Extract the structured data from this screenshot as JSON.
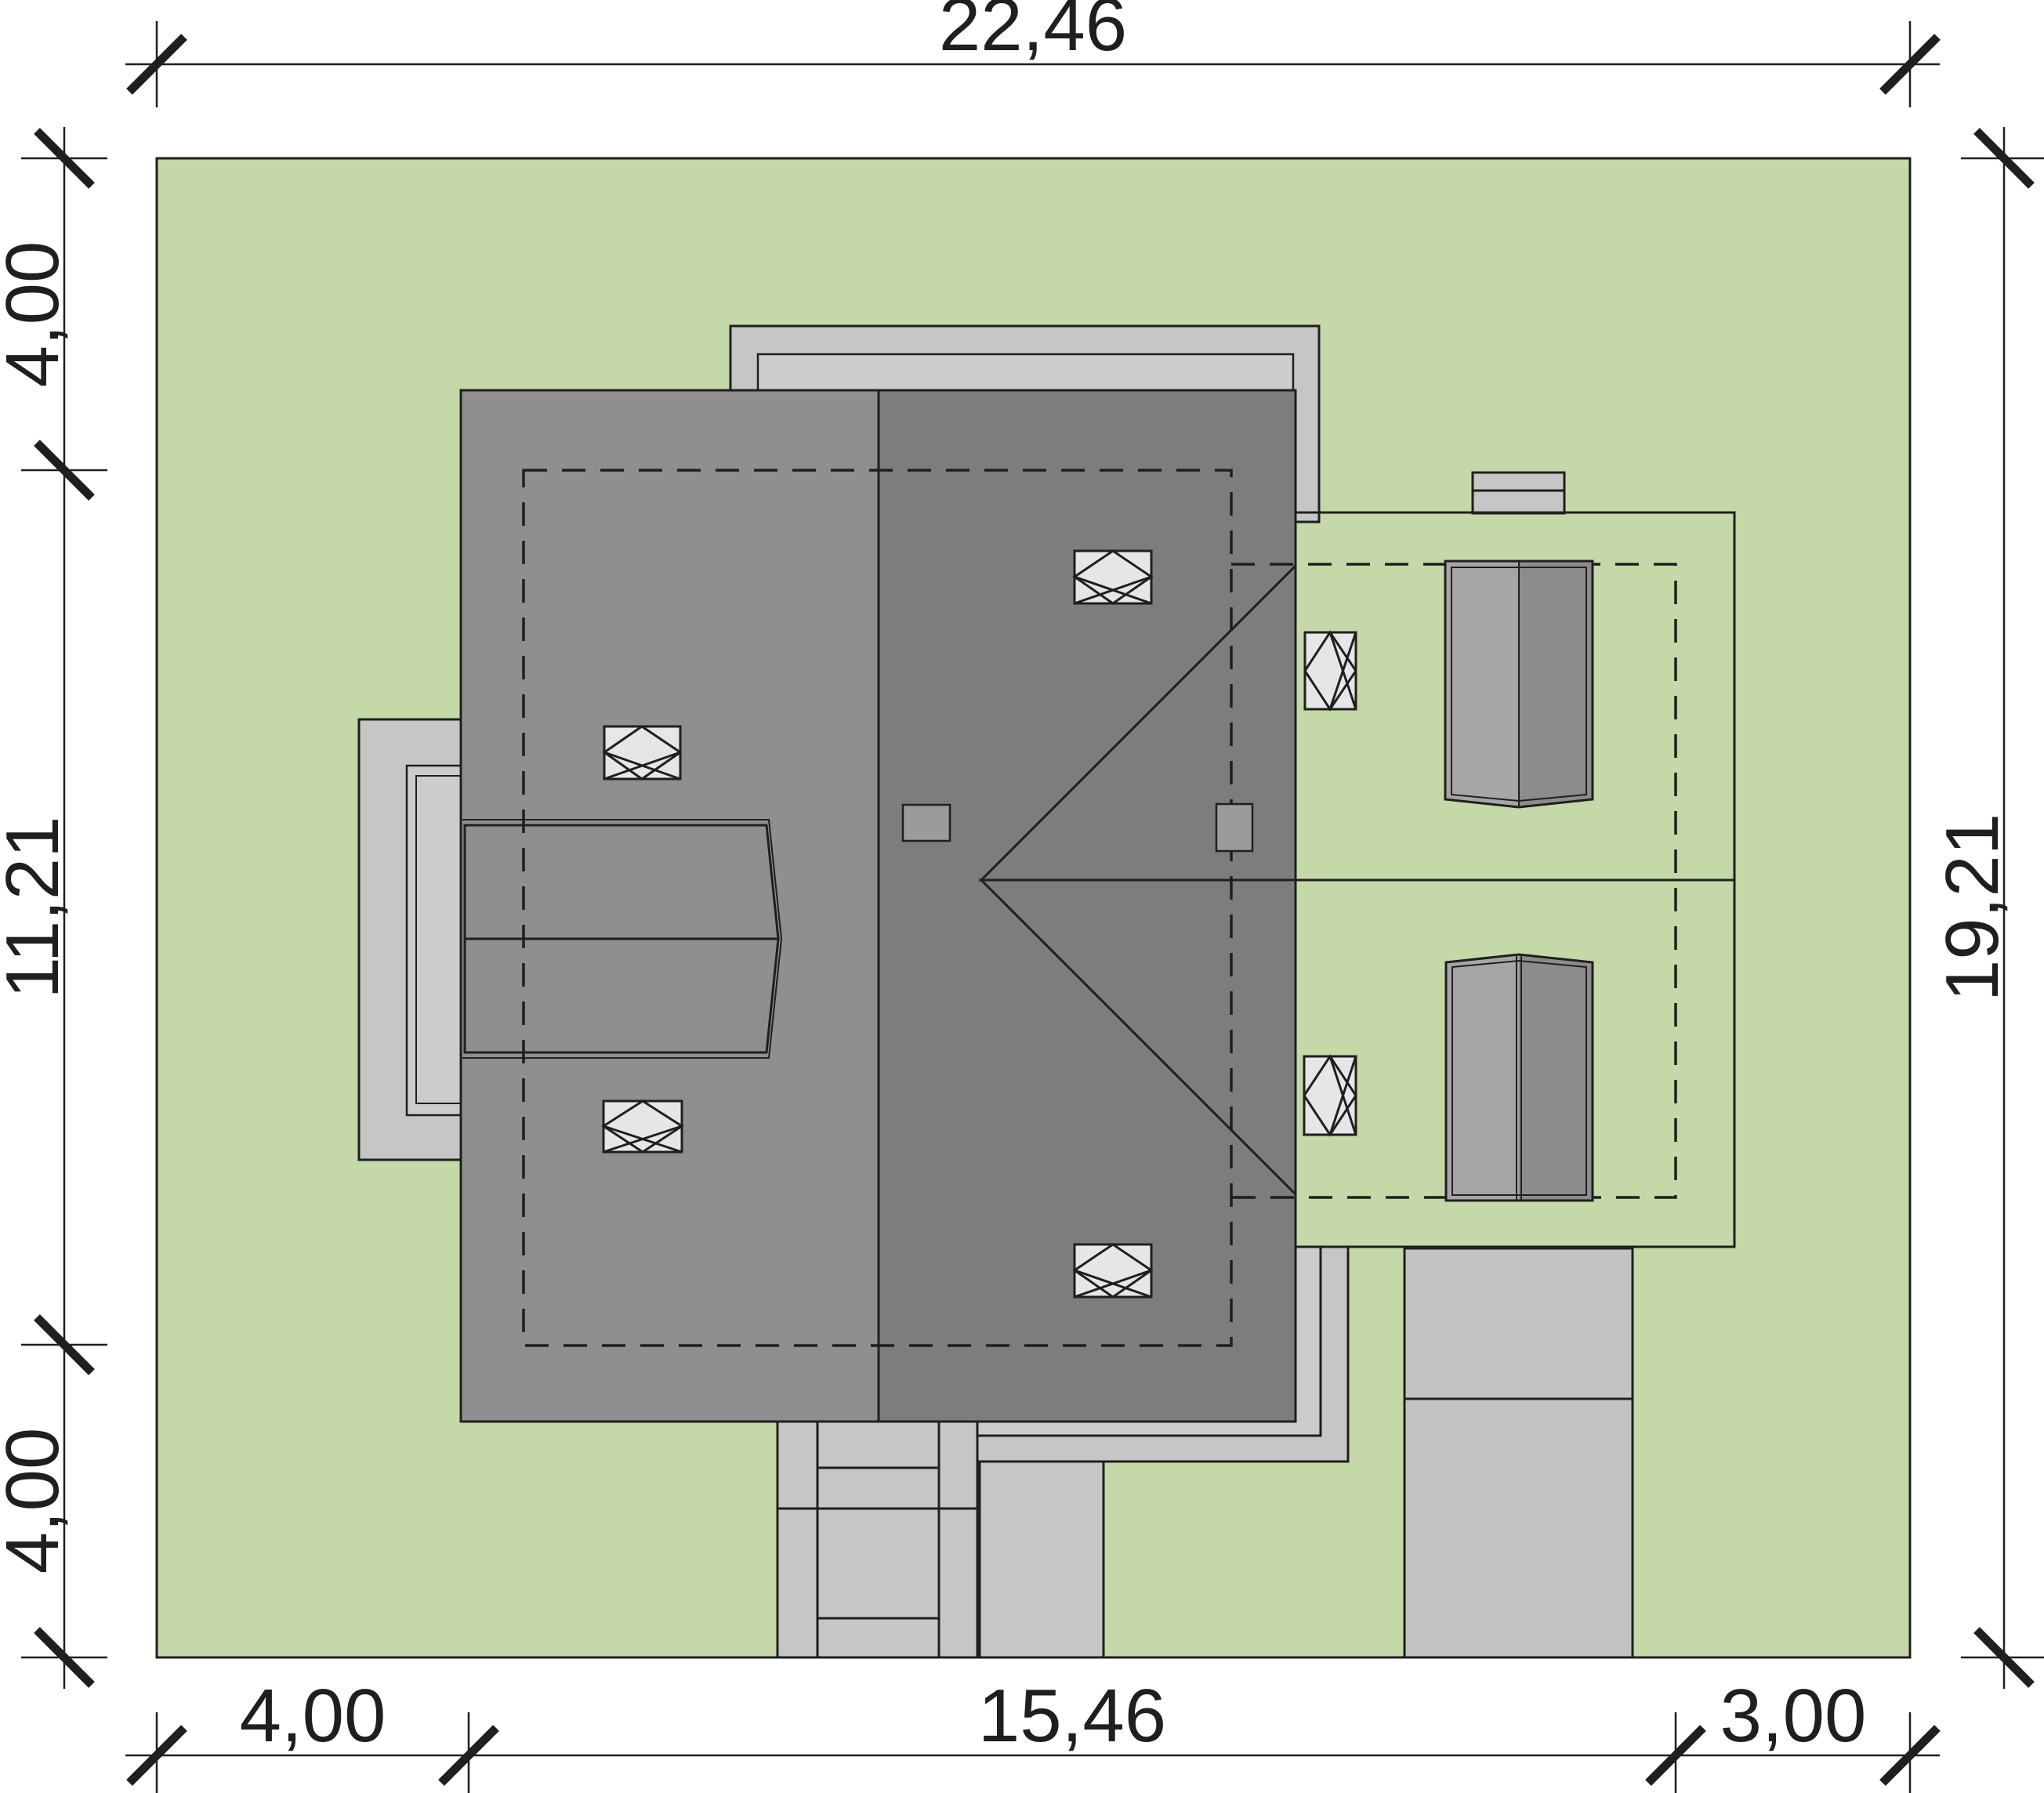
{
  "drawing": {
    "type": "site-plan",
    "dimensions": {
      "top": {
        "total_width": "22,46"
      },
      "bottom": {
        "left_setback": "4,00",
        "building_width": "15,46",
        "right_setback": "3,00"
      },
      "left": {
        "top_setback": "4,00",
        "building_depth": "11,21",
        "bottom_setback": "4,00"
      },
      "right": {
        "total_depth": "19,21"
      }
    }
  },
  "colors": {
    "ink": "#1f1f1f",
    "grass": "#c5d8a8",
    "pave": "#c6c6c6",
    "paveLight": "#cccccc",
    "drive": "#c3c3c3",
    "roofLeft": "#908e8e",
    "roofRight": "#7e7c7c",
    "wingUpper": "#949292",
    "wingLower": "#858383",
    "dormerUpper": "#959393",
    "dormerLower": "#7d7b7b",
    "skylight": "#e6e6e6",
    "chimney": "#c6c6c6",
    "chimsq": "#9c9a9a",
    "paneLight": "#a7a5a5",
    "paneDark": "#8d8b8b"
  }
}
